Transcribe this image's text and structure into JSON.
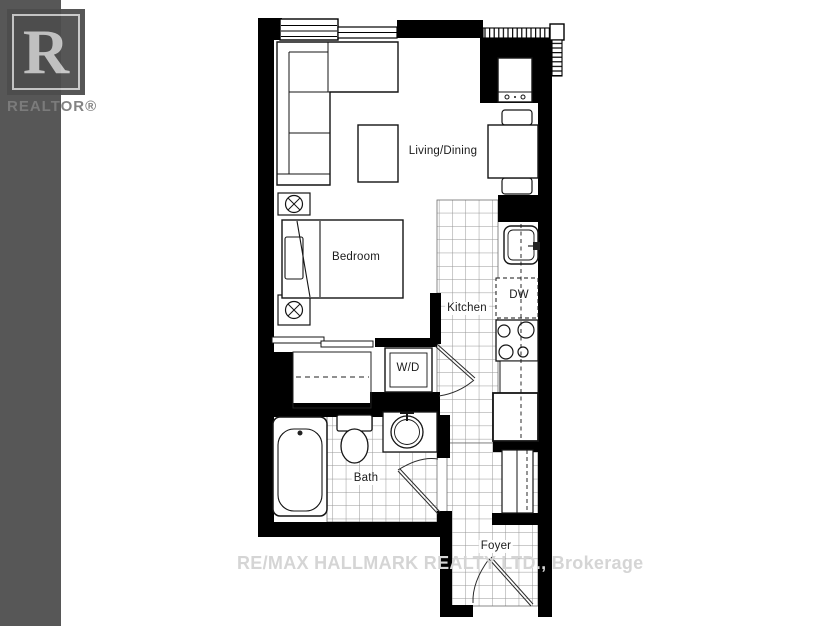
{
  "branding": {
    "logo_letter": "R",
    "logo_label": "REALTOR®"
  },
  "watermark_text": "RE/MAX HALLMARK REALTY LTD., Brokerage",
  "floorplan": {
    "rooms": {
      "living_dining": "Living/Dining",
      "bedroom": "Bedroom",
      "kitchen": "Kitchen",
      "bath": "Bath",
      "foyer": "Foyer"
    },
    "appliances": {
      "dishwasher": "DW",
      "washer_dryer": "W/D"
    }
  },
  "colors": {
    "walls": "#000000",
    "sidebar": "#575757",
    "watermark_gray": "#d5d5d5",
    "tile_line": "#969696"
  }
}
